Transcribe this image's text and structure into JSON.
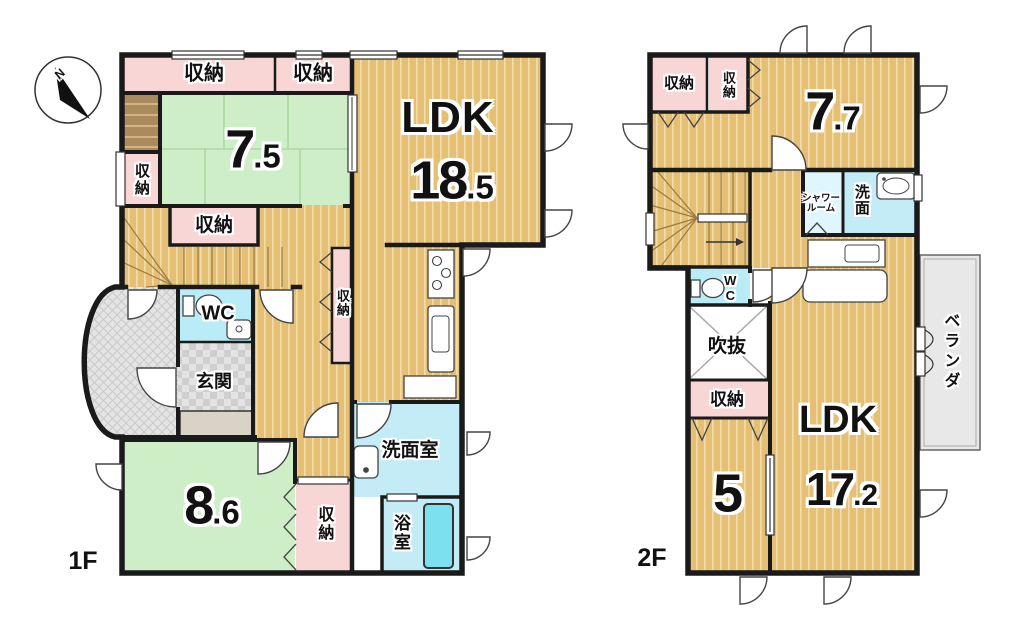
{
  "compass": {
    "north": "N"
  },
  "floor1": {
    "label": "1F",
    "ldk": {
      "name": "LDK",
      "size_int": "18",
      "size_dec": ".5"
    },
    "tatami": {
      "size_int": "7",
      "size_dec": ".5"
    },
    "bedroom": {
      "size_int": "8",
      "size_dec": ".6"
    },
    "storage_top_left": "収納",
    "storage_top_right": "収納",
    "storage_left": "収納",
    "storage_stairs": "収納",
    "storage_hall": "収納",
    "storage_bottom": "収納",
    "wc": "WC",
    "entrance": "玄関",
    "washroom": "洗面室",
    "bathroom": "浴室"
  },
  "floor2": {
    "label": "2F",
    "room77": {
      "size_int": "7",
      "size_dec": ".7"
    },
    "room5": {
      "size_int": "5"
    },
    "ldk": {
      "name": "LDK",
      "size_int": "17",
      "size_dec": ".2"
    },
    "storage_a": "収納",
    "storage_b": "収納",
    "storage_c": "収納",
    "shower_line1": "シャワー",
    "shower_line2": "ルーム",
    "washroom": "洗面",
    "wc": "WC",
    "void": "吹抜",
    "veranda": "ベランダ"
  },
  "colors": {
    "wood": "#e5bf76",
    "tatami": "#cdeec6",
    "storage": "#f9d6d6",
    "water": "#c3ecf7",
    "bathtub": "#7ce0ee",
    "porch": "#e4e4e4",
    "veranda": "#e8e8e8",
    "wall": "#1a1a1a"
  }
}
